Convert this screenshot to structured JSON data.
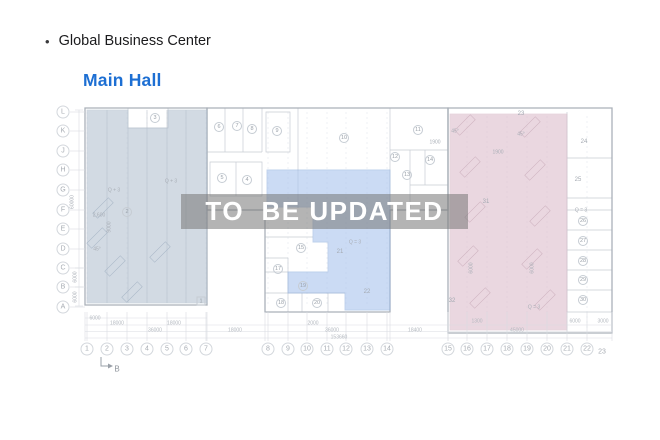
{
  "header": {
    "bullet": "•",
    "title": "Global Business Center",
    "subtitle": "Main Hall"
  },
  "watermark": {
    "text": "TO  BE UPDATED"
  },
  "colors": {
    "accent_blue": "#1d6fd3",
    "region_left": "#b7c4d3",
    "region_middle": "#a9c4ee",
    "region_right": "#ddbecd",
    "wall": "#aab1b9",
    "inner_line": "#c7ccd3",
    "dim_line": "#d9dce1",
    "grid_line": "#e4e8ed",
    "watermark_bg": "rgba(118,118,118,0.55)"
  },
  "floorplan": {
    "row_axis": [
      {
        "label": "L",
        "x": 63,
        "y": 112
      },
      {
        "label": "K",
        "x": 63,
        "y": 131
      },
      {
        "label": "J",
        "x": 63,
        "y": 151
      },
      {
        "label": "H",
        "x": 63,
        "y": 170
      },
      {
        "label": "G",
        "x": 63,
        "y": 190
      },
      {
        "label": "F",
        "x": 63,
        "y": 210
      },
      {
        "label": "E",
        "x": 63,
        "y": 229
      },
      {
        "label": "D",
        "x": 63,
        "y": 249
      },
      {
        "label": "C",
        "x": 63,
        "y": 268
      },
      {
        "label": "B",
        "x": 63,
        "y": 287
      },
      {
        "label": "A",
        "x": 63,
        "y": 307
      }
    ],
    "col_axis": [
      {
        "label": "1",
        "x": 87
      },
      {
        "label": "2",
        "x": 107
      },
      {
        "label": "3",
        "x": 127
      },
      {
        "label": "4",
        "x": 147
      },
      {
        "label": "5",
        "x": 167
      },
      {
        "label": "6",
        "x": 186
      },
      {
        "label": "7",
        "x": 206
      },
      {
        "label": "8",
        "x": 268
      },
      {
        "label": "9",
        "x": 288
      },
      {
        "label": "10",
        "x": 307
      },
      {
        "label": "11",
        "x": 327
      },
      {
        "label": "12",
        "x": 346
      },
      {
        "label": "13",
        "x": 367
      },
      {
        "label": "14",
        "x": 387
      },
      {
        "label": "15",
        "x": 448
      },
      {
        "label": "16",
        "x": 467
      },
      {
        "label": "17",
        "x": 487
      },
      {
        "label": "18",
        "x": 507
      },
      {
        "label": "19",
        "x": 527
      },
      {
        "label": "20",
        "x": 547
      },
      {
        "label": "21",
        "x": 567
      },
      {
        "label": "22",
        "x": 587
      }
    ],
    "col_axis_y": 349,
    "col_23": {
      "label": "23",
      "x": 602,
      "y": 352
    },
    "section_marker": {
      "label": "B",
      "x": 117,
      "y": 369
    },
    "rooms": [
      {
        "n": "2",
        "x": 127,
        "y": 212
      },
      {
        "n": "3",
        "x": 155,
        "y": 118
      },
      {
        "n": "4",
        "x": 247,
        "y": 180
      },
      {
        "n": "5",
        "x": 222,
        "y": 178
      },
      {
        "n": "6",
        "x": 219,
        "y": 127
      },
      {
        "n": "7",
        "x": 237,
        "y": 126
      },
      {
        "n": "8",
        "x": 252,
        "y": 129
      },
      {
        "n": "9",
        "x": 277,
        "y": 131
      },
      {
        "n": "10",
        "x": 344,
        "y": 138
      },
      {
        "n": "11",
        "x": 418,
        "y": 130
      },
      {
        "n": "12",
        "x": 395,
        "y": 157
      },
      {
        "n": "13",
        "x": 407,
        "y": 175
      },
      {
        "n": "14",
        "x": 430,
        "y": 160
      },
      {
        "n": "15",
        "x": 301,
        "y": 248
      },
      {
        "n": "17",
        "x": 278,
        "y": 269
      },
      {
        "n": "18",
        "x": 281,
        "y": 303
      },
      {
        "n": "19",
        "x": 303,
        "y": 286
      },
      {
        "n": "20",
        "x": 317,
        "y": 303
      },
      {
        "n": "26",
        "x": 583,
        "y": 221
      },
      {
        "n": "27",
        "x": 583,
        "y": 241
      },
      {
        "n": "28",
        "x": 583,
        "y": 261
      },
      {
        "n": "29",
        "x": 583,
        "y": 280
      },
      {
        "n": "30",
        "x": 583,
        "y": 300
      }
    ],
    "rooms_plain": [
      {
        "n": "21",
        "x": 340,
        "y": 252
      },
      {
        "n": "22",
        "x": 367,
        "y": 292
      },
      {
        "n": "24",
        "x": 584,
        "y": 142
      },
      {
        "n": "25",
        "x": 578,
        "y": 180
      },
      {
        "n": "31",
        "x": 486,
        "y": 202
      },
      {
        "n": "32",
        "x": 452,
        "y": 301
      },
      {
        "n": "23",
        "x": 521,
        "y": 114
      }
    ],
    "rooms_square": [
      {
        "n": "1",
        "x": 201,
        "y": 301
      }
    ],
    "annotations": [
      {
        "t": "Q + 3",
        "x": 114,
        "y": 191
      },
      {
        "t": "Q + 3",
        "x": 171,
        "y": 182
      },
      {
        "t": "2,600",
        "x": 99,
        "y": 216
      },
      {
        "t": "45°",
        "x": 97,
        "y": 250
      },
      {
        "t": "45°",
        "x": 455,
        "y": 132
      },
      {
        "t": "45°",
        "x": 521,
        "y": 135
      },
      {
        "t": "1900",
        "x": 435,
        "y": 143
      },
      {
        "t": "1900",
        "x": 498,
        "y": 153
      },
      {
        "t": "Q = 3",
        "x": 355,
        "y": 243
      },
      {
        "t": "Q = 3",
        "x": 581,
        "y": 211
      },
      {
        "t": "Q = 3",
        "x": 534,
        "y": 308
      },
      {
        "t": "9000",
        "x": 110,
        "y": 227,
        "rot": true
      },
      {
        "t": "60000",
        "x": 73,
        "y": 202,
        "rot": true
      },
      {
        "t": "6000",
        "x": 76,
        "y": 277,
        "rot": true
      },
      {
        "t": "6000",
        "x": 76,
        "y": 297,
        "rot": true
      },
      {
        "t": "6000",
        "x": 472,
        "y": 268,
        "rot": true
      },
      {
        "t": "6000",
        "x": 533,
        "y": 268,
        "rot": true
      }
    ],
    "dimensions": [
      {
        "t": "6000",
        "x": 95,
        "y": 319
      },
      {
        "t": "18000",
        "x": 117,
        "y": 324
      },
      {
        "t": "18000",
        "x": 174,
        "y": 324
      },
      {
        "t": "36000",
        "x": 155,
        "y": 331
      },
      {
        "t": "18000",
        "x": 235,
        "y": 331
      },
      {
        "t": "2000",
        "x": 313,
        "y": 324
      },
      {
        "t": "36000",
        "x": 332,
        "y": 331
      },
      {
        "t": "153660",
        "x": 339,
        "y": 338
      },
      {
        "t": "18400",
        "x": 415,
        "y": 331
      },
      {
        "t": "1300",
        "x": 477,
        "y": 322
      },
      {
        "t": "45000",
        "x": 517,
        "y": 331
      },
      {
        "t": "6000",
        "x": 575,
        "y": 322
      },
      {
        "t": "3000",
        "x": 603,
        "y": 322
      }
    ]
  }
}
